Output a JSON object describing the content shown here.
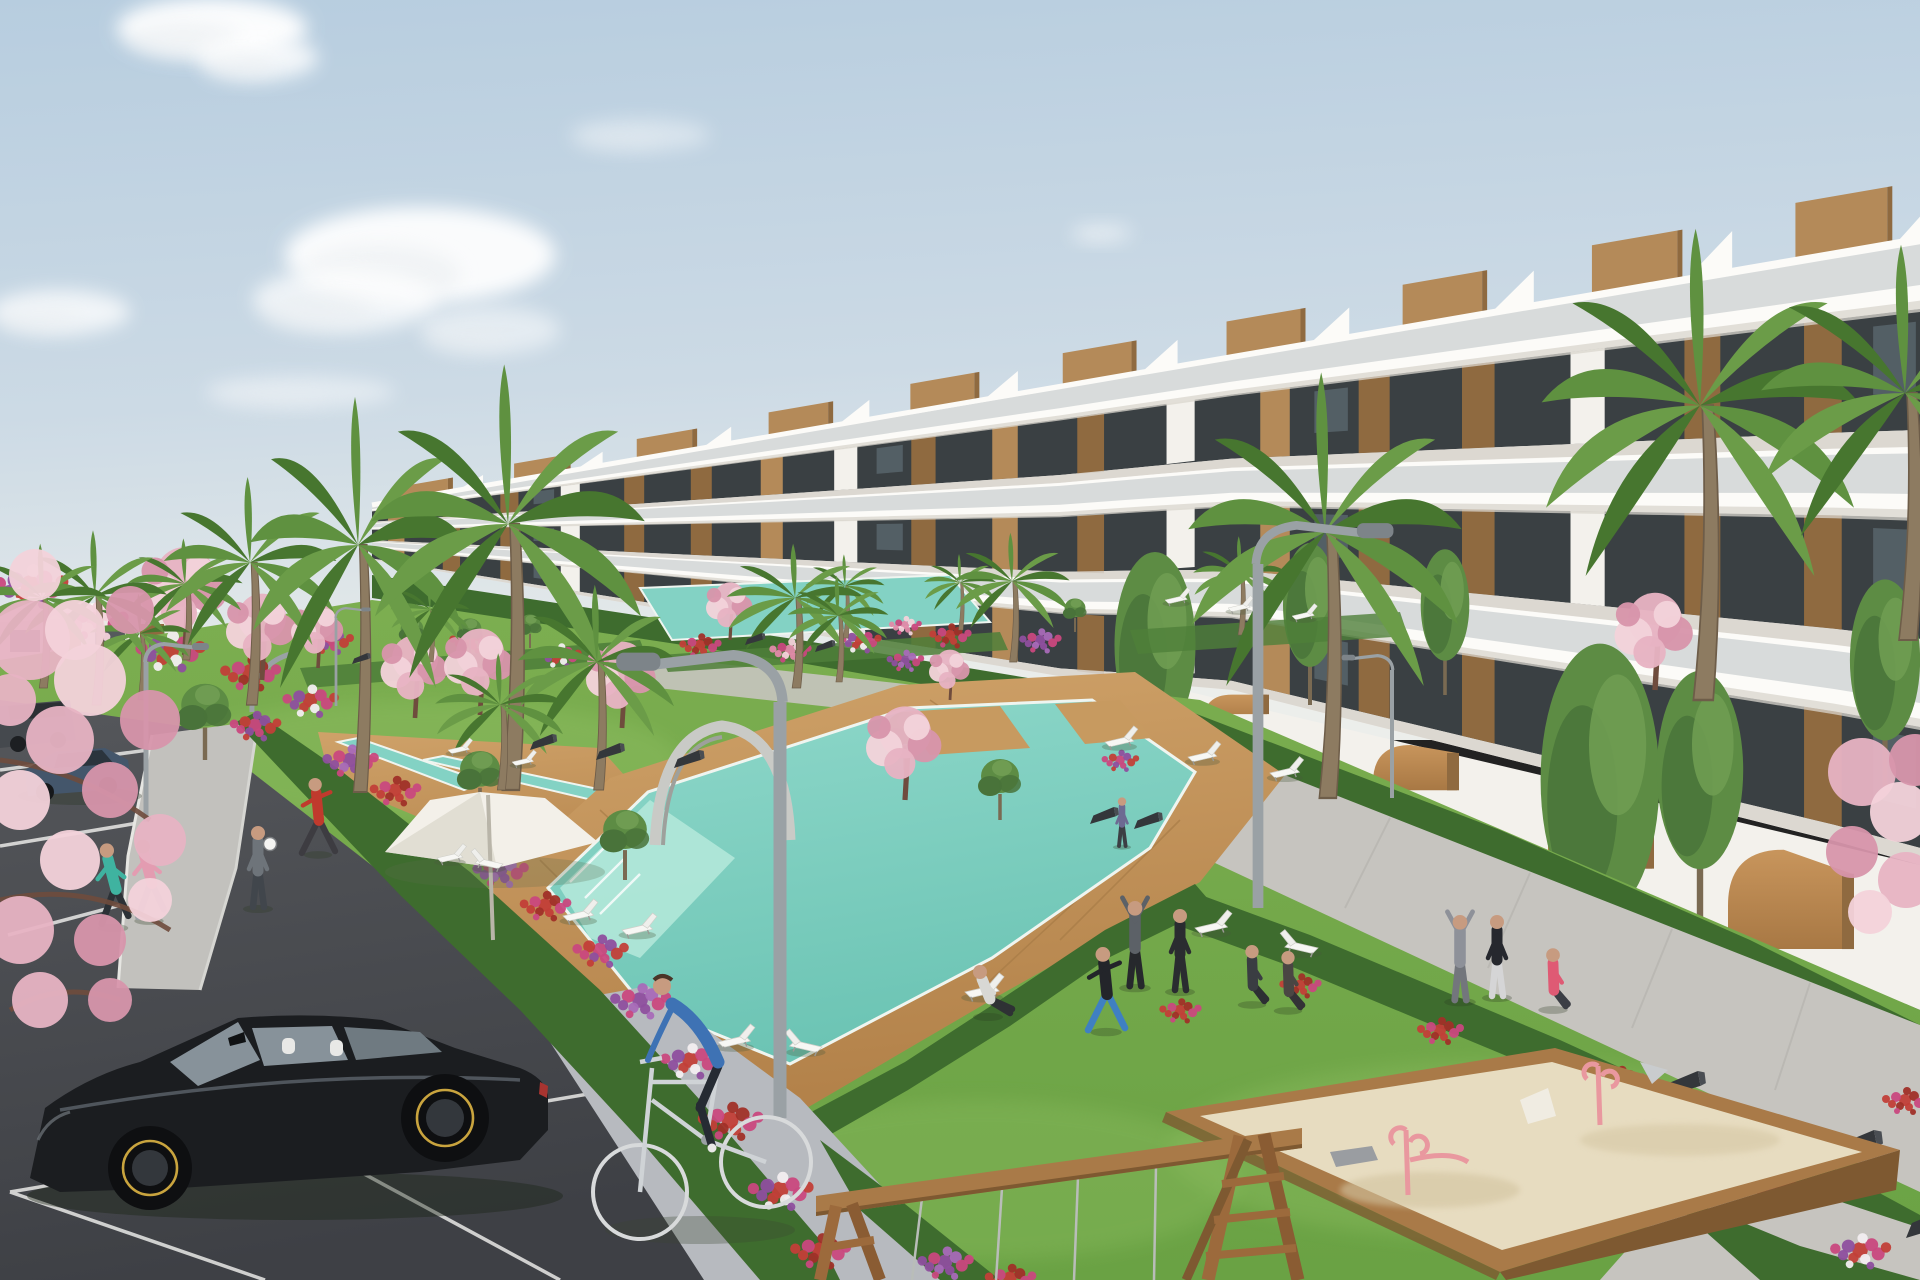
{
  "meta": {
    "title": "New-build residential resort complex — exterior visualization",
    "description": "3D architectural render: terraced white apartment building with wood accents, landscaped gardens, cascading turquoise pools, sun loungers, parasol, parking lot with black hatchback, cyclist, joggers, playground sandbox and swing frame under a pale blue sky."
  },
  "palette": {
    "sky_top": "#b7cddf",
    "sky_mid": "#ccdae5",
    "sky_horizon": "#eceeeb",
    "cloud": "#ffffff",
    "building_white": "#f3f1ec",
    "building_bright": "#fcfbf8",
    "building_shadow": "#d9d5ce",
    "building_dark": "#c6c2ba",
    "glass_dark": "#2f363a",
    "glass_mid": "#5a676e",
    "glass_light": "#8798a0",
    "balustrade": "#8b989e",
    "wood": "#b48a59",
    "wood_dark": "#8f6a40",
    "wood_light": "#c9a06b",
    "distant_wall": "#ebe9e4",
    "ochre": "#c08b55",
    "ochre_dark": "#8a6239",
    "grass": "#74a84b",
    "grass_light": "#8dbd60",
    "grass_dark": "#5a8a3b",
    "hedge": "#3e6c2e",
    "hedge_dark": "#2f5724",
    "hedge_light": "#4f7f3a",
    "tree": "#5d8c44",
    "tree_dark": "#49733a",
    "palm": "#5f9140",
    "palm_dark": "#47762f",
    "trunk": "#8d7b61",
    "trunk_dark": "#6e5d49",
    "blossom": "#e7b3c3",
    "blossom_light": "#f3d2da",
    "blossom_dark": "#d795ab",
    "branch": "#6f4c3d",
    "flower_red": "#c23f38",
    "flower_magenta": "#c9487e",
    "flower_purple": "#8e4f9e",
    "flower_white": "#f2eef0",
    "flower_pink": "#e08aa8",
    "pool": "#83d2c4",
    "pool_light": "#b5e9da",
    "pool_deep": "#62bfae",
    "deck": "#c79a60",
    "deck_dark": "#ab7d48",
    "path": "#c6c4bf",
    "paver": "#b7babf",
    "sidewalk": "#c2c1bd",
    "asphalt": "#515357",
    "asphalt_dark": "#3f4145",
    "line_white": "#e9e9e7",
    "lamp": "#9aa1a5",
    "lamp_dark": "#7d8489",
    "umbrella": "#f3f0e9",
    "umbrella_shadow": "#d9d5c9",
    "sand": "#e7dcc0",
    "sand_shadow": "#d3c4a0",
    "box_wood": "#a97a48",
    "box_wood_dark": "#7e5931",
    "toy_pink": "#e9989f",
    "toy_grey": "#9a9da1",
    "chain": "#b9bdb9",
    "skin": "#c79b80",
    "car_black": "#1b1d20",
    "car_glass": "#87929a",
    "car_trim": "#c9a43e",
    "sedan_blue": "#44566b",
    "suv_grey": "#45494e"
  },
  "scene": {
    "clouds": [
      [
        212,
        28,
        95,
        30,
        0.95
      ],
      [
        258,
        58,
        60,
        22,
        0.8
      ],
      [
        420,
        255,
        135,
        48,
        0.92
      ],
      [
        345,
        300,
        92,
        32,
        0.7
      ],
      [
        60,
        312,
        70,
        22,
        0.75
      ],
      [
        300,
        392,
        95,
        16,
        0.45
      ],
      [
        640,
        135,
        70,
        16,
        0.4
      ],
      [
        1102,
        233,
        30,
        9,
        0.5
      ],
      [
        490,
        330,
        70,
        24,
        0.5
      ]
    ],
    "palms": [
      [
        185,
        660,
        0.8,
        0.8
      ],
      [
        140,
        700,
        0.7,
        0.7
      ],
      [
        95,
        705,
        1.15,
        1.0
      ],
      [
        42,
        688,
        0.95,
        0.9
      ],
      [
        250,
        705,
        1.5,
        1.2
      ],
      [
        430,
        662,
        0.55,
        0.55
      ],
      [
        845,
        638,
        0.55,
        0.55
      ],
      [
        960,
        630,
        0.5,
        0.5
      ],
      [
        1240,
        635,
        0.65,
        0.65
      ],
      [
        1012,
        662,
        0.85,
        0.8
      ],
      [
        795,
        688,
        0.95,
        0.95
      ],
      [
        838,
        682,
        0.7,
        0.7
      ],
      [
        1700,
        700,
        3.1,
        2.2
      ],
      [
        1905,
        640,
        2.6,
        2.0
      ],
      [
        358,
        792,
        2.6,
        1.5
      ],
      [
        508,
        790,
        2.8,
        1.9
      ],
      [
        1325,
        798,
        2.8,
        1.9
      ],
      [
        597,
        790,
        1.35,
        1.1
      ],
      [
        500,
        790,
        0.9,
        0.9
      ]
    ],
    "tall_trees": [
      [
        1310,
        705,
        1.0
      ],
      [
        1445,
        695,
        0.9
      ],
      [
        1155,
        795,
        1.5
      ],
      [
        1600,
        1000,
        2.2
      ],
      [
        1700,
        930,
        1.6
      ],
      [
        1885,
        790,
        1.3
      ]
    ],
    "blossoms": [
      [
        415,
        718,
        1.15
      ],
      [
        480,
        715,
        1.2
      ],
      [
        622,
        728,
        1.2
      ],
      [
        730,
        640,
        0.8
      ],
      [
        950,
        700,
        0.7
      ],
      [
        185,
        655,
        1.5
      ],
      [
        262,
        680,
        1.2
      ],
      [
        318,
        668,
        0.9
      ],
      [
        905,
        800,
        1.3
      ],
      [
        1655,
        690,
        1.35
      ]
    ],
    "olives": [
      [
        412,
        655,
        0.6
      ],
      [
        530,
        648,
        0.55
      ],
      [
        1075,
        632,
        0.55
      ],
      [
        205,
        760,
        1.25
      ],
      [
        480,
        815,
        1.05
      ],
      [
        625,
        880,
        1.15
      ],
      [
        905,
        770,
        0.95
      ],
      [
        1000,
        820,
        1.0
      ],
      [
        470,
        655,
        0.6
      ]
    ],
    "flowers": [
      [
        30,
        585,
        1.6,
        "mix"
      ],
      [
        95,
        620,
        1.4,
        "pink"
      ],
      [
        170,
        650,
        1.5,
        "mix"
      ],
      [
        250,
        672,
        1.3,
        "red"
      ],
      [
        310,
        700,
        1.2,
        "mix"
      ],
      [
        255,
        725,
        1.1,
        "magenta"
      ],
      [
        350,
        760,
        1.2,
        "purple"
      ],
      [
        395,
        790,
        1.1,
        "red"
      ],
      [
        440,
        825,
        1.2,
        "mix"
      ],
      [
        500,
        870,
        1.2,
        "purple"
      ],
      [
        545,
        905,
        1.1,
        "red"
      ],
      [
        600,
        950,
        1.2,
        "magenta"
      ],
      [
        640,
        1000,
        1.3,
        "purple"
      ],
      [
        690,
        1060,
        1.3,
        "mix"
      ],
      [
        730,
        1120,
        1.4,
        "red"
      ],
      [
        780,
        1190,
        1.4,
        "mix"
      ],
      [
        820,
        1250,
        1.3,
        "red"
      ],
      [
        470,
        640,
        0.9,
        "red"
      ],
      [
        560,
        655,
        0.9,
        "mix"
      ],
      [
        700,
        645,
        0.9,
        "red"
      ],
      [
        790,
        650,
        0.9,
        "pink"
      ],
      [
        860,
        640,
        0.9,
        "mix"
      ],
      [
        950,
        635,
        0.9,
        "red"
      ],
      [
        1040,
        640,
        0.9,
        "purple"
      ],
      [
        330,
        640,
        1.0,
        "magenta"
      ],
      [
        1180,
        1010,
        0.9,
        "red"
      ],
      [
        1300,
        985,
        0.9,
        "red"
      ],
      [
        1440,
        1030,
        1.0,
        "red"
      ],
      [
        1620,
        1080,
        1.1,
        "red"
      ],
      [
        1700,
        1130,
        1.2,
        "mix"
      ],
      [
        1780,
        1190,
        1.2,
        "red"
      ],
      [
        1860,
        1250,
        1.3,
        "mix"
      ],
      [
        1905,
        1100,
        1.0,
        "red"
      ],
      [
        905,
        660,
        0.8,
        "purple"
      ],
      [
        1120,
        760,
        0.8,
        "magenta"
      ],
      [
        945,
        1262,
        1.2,
        "purple"
      ],
      [
        1010,
        1278,
        1.1,
        "red"
      ],
      [
        905,
        625,
        0.7,
        "pink"
      ]
    ],
    "lamps": [
      [
        336,
        706,
        0.55,
        1
      ],
      [
        146,
        822,
        1.0,
        1
      ],
      [
        1392,
        798,
        0.8,
        -1
      ],
      [
        1258,
        908,
        2.15,
        1
      ],
      [
        780,
        1118,
        2.6,
        -1
      ]
    ],
    "loungers": [
      [
        1165,
        600,
        0.62,
        0
      ],
      [
        1228,
        608,
        0.62,
        0
      ],
      [
        1292,
        616,
        0.62,
        0
      ],
      [
        448,
        750,
        0.6,
        0
      ],
      [
        512,
        762,
        0.6,
        0
      ],
      [
        437,
        858,
        0.72,
        0
      ],
      [
        503,
        864,
        0.78,
        1
      ],
      [
        563,
        916,
        0.85,
        0
      ],
      [
        622,
        930,
        0.85,
        0
      ],
      [
        718,
        1042,
        0.9,
        0
      ],
      [
        822,
        1047,
        0.9,
        1
      ],
      [
        1105,
        742,
        0.8,
        0
      ],
      [
        1188,
        757,
        0.8,
        0
      ],
      [
        1270,
        773,
        0.82,
        0
      ],
      [
        1195,
        928,
        0.9,
        0
      ],
      [
        1318,
        948,
        0.92,
        1
      ],
      [
        965,
        992,
        0.95,
        0
      ]
    ],
    "benches": [
      [
        352,
        664,
        0.55
      ],
      [
        745,
        645,
        0.6
      ],
      [
        815,
        652,
        0.6
      ],
      [
        530,
        750,
        0.8
      ],
      [
        596,
        760,
        0.85
      ],
      [
        674,
        768,
        0.9
      ],
      [
        1090,
        824,
        0.85
      ],
      [
        1134,
        829,
        0.85
      ],
      [
        1660,
        1098,
        1.35
      ],
      [
        1832,
        1160,
        1.5
      ],
      [
        1906,
        1238,
        1.5
      ]
    ],
    "people": [
      {
        "pose": "stand",
        "x": 1122,
        "y": 846,
        "s": 0.6,
        "shirt": "#6d6a92",
        "pants": "#3c3f44"
      },
      {
        "pose": "lunge",
        "x": 318,
        "y": 853,
        "s": 0.95,
        "shirt": "#c03a2d",
        "pants": "#3d3c41"
      },
      {
        "pose": "stand",
        "x": 258,
        "y": 907,
        "s": 1.0,
        "shirt": "#6e747a",
        "pants": "#41464c"
      },
      {
        "pose": "jog",
        "x": 113,
        "y": 926,
        "s": 1.02,
        "shirt": "#3fb3a0",
        "pants": "#2c3136"
      },
      {
        "pose": "jog",
        "x": 149,
        "y": 919,
        "s": 0.98,
        "shirt": "#e39cb1",
        "pants": "#9aa0a6"
      },
      {
        "pose": "armsup",
        "x": 1460,
        "y": 1000,
        "s": 1.05,
        "shirt": "#8e9199",
        "pants": "#73767c"
      },
      {
        "pose": "stand",
        "x": 1497,
        "y": 996,
        "s": 1.0,
        "shirt": "#26282e",
        "pants": "#d5d5d6"
      },
      {
        "pose": "sit",
        "x": 1553,
        "y": 1008,
        "s": 0.98,
        "shirt": "#df5a74",
        "pants": "#3b3e45"
      },
      {
        "pose": "armsup",
        "x": 1135,
        "y": 986,
        "s": 1.05,
        "shirt": "#5c6167",
        "pants": "#26282c"
      },
      {
        "pose": "stand",
        "x": 1180,
        "y": 990,
        "s": 1.0,
        "shirt": "#2a2c30",
        "pants": "#2a2c30"
      },
      {
        "pose": "lunge",
        "x": 1106,
        "y": 1030,
        "s": 1.05,
        "shirt": "#23252a",
        "pants": "#3f80c2"
      },
      {
        "pose": "sit",
        "x": 1252,
        "y": 1003,
        "s": 0.95,
        "shirt": "#3a3d42",
        "pants": "#2c2f33"
      },
      {
        "pose": "sit",
        "x": 1288,
        "y": 1009,
        "s": 0.95,
        "shirt": "#4a4643",
        "pants": "#333236"
      },
      {
        "pose": "recline",
        "x": 988,
        "y": 1015,
        "s": 1.0,
        "shirt": "#d8d8d4",
        "pants": "#2e3134"
      }
    ],
    "fg_blossoms": [
      [
        30,
        640,
        40,
        0
      ],
      [
        90,
        680,
        36,
        1
      ],
      [
        150,
        720,
        30,
        2
      ],
      [
        60,
        740,
        34,
        0
      ],
      [
        20,
        800,
        30,
        1
      ],
      [
        110,
        790,
        28,
        2
      ],
      [
        160,
        840,
        26,
        0
      ],
      [
        70,
        860,
        30,
        1
      ],
      [
        20,
        930,
        34,
        0
      ],
      [
        100,
        940,
        26,
        2
      ],
      [
        150,
        900,
        22,
        1
      ],
      [
        40,
        1000,
        28,
        0
      ],
      [
        110,
        1000,
        22,
        2
      ],
      [
        75,
        630,
        30,
        1
      ],
      [
        10,
        700,
        26,
        0
      ],
      [
        35,
        575,
        26,
        1
      ],
      [
        130,
        610,
        24,
        2
      ],
      [
        1862,
        772,
        34,
        0
      ],
      [
        1900,
        812,
        30,
        1
      ],
      [
        1852,
        852,
        26,
        2
      ],
      [
        1906,
        880,
        28,
        0
      ],
      [
        1870,
        912,
        22,
        1
      ],
      [
        1915,
        760,
        26,
        2
      ]
    ],
    "ball": {
      "x": 270,
      "y": 844,
      "r": 6.5
    }
  }
}
